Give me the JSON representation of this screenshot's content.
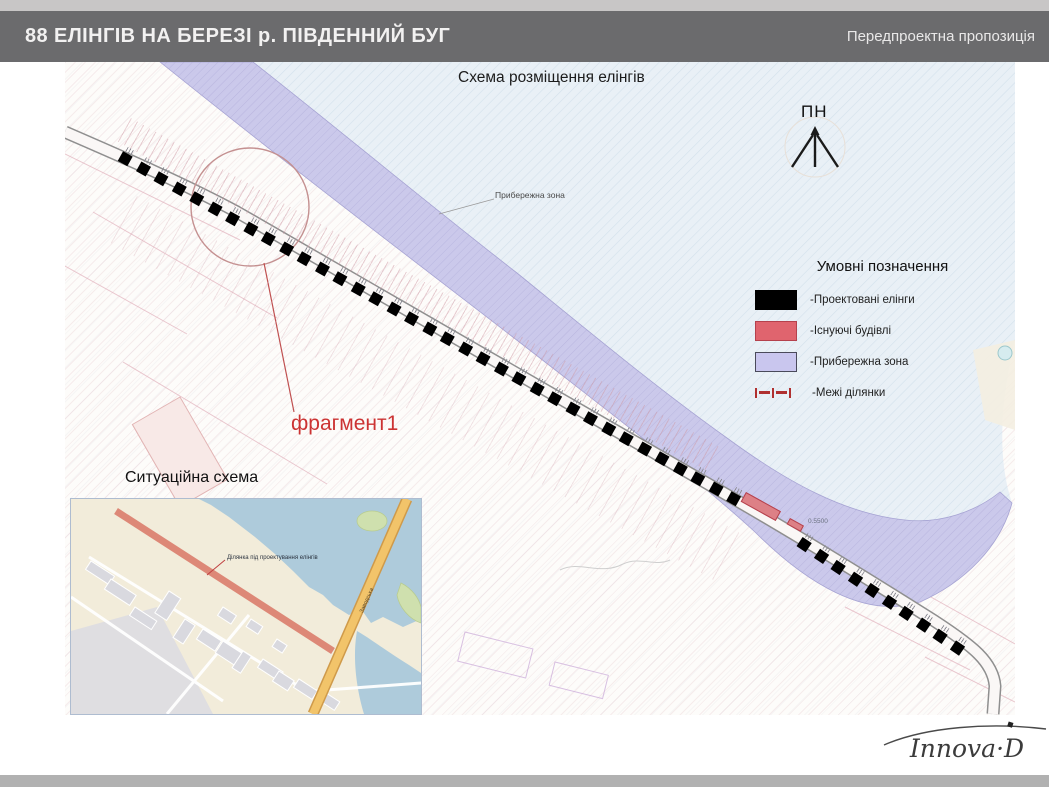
{
  "header": {
    "title": "88 ЕЛІНГІВ НА БЕРЕЗІ р. ПІВДЕННИЙ БУГ",
    "right_label": "Передпроектна пропозиція"
  },
  "map": {
    "title": "Схема розміщення елінгів",
    "north_label": "ПН",
    "coastal_label": "Прибережна зона",
    "fragment_label": "фрагмент1",
    "dimension_label": "0.5500",
    "elings": {
      "segment_a_count": 35,
      "segment_b_count": 10
    }
  },
  "legend": {
    "title": "Умовні позначення",
    "items": [
      {
        "type": "swatch",
        "color": "#000000",
        "border": "#000000",
        "label": "-Проектовані елінги"
      },
      {
        "type": "swatch",
        "color": "#e0646e",
        "border": "#b5414d",
        "label": "-Існуючі будівлі"
      },
      {
        "type": "swatch",
        "color": "#c9c6ee",
        "border": "#4a4a5a",
        "label": "-Прибережна зона"
      },
      {
        "type": "dashed-line",
        "color": "#b03030",
        "label": "-Межі ділянки"
      }
    ]
  },
  "inset": {
    "title": "Ситуаційна схема",
    "site_label": "Ділянка під проектування елінгів",
    "road_label": "Заводська"
  },
  "footer": {
    "logo_text": "Innova·D"
  },
  "colors": {
    "header_bg": "#6b6b6d",
    "top_strip": "#c8c6c6",
    "bottom_bar": "#b1b1b1",
    "river": "#e9f0f6",
    "coastal_band": "#c7c5ea",
    "projected_eling": "#000000",
    "existing_building": "#dd8086",
    "fragment_accent": "#cc3333"
  }
}
